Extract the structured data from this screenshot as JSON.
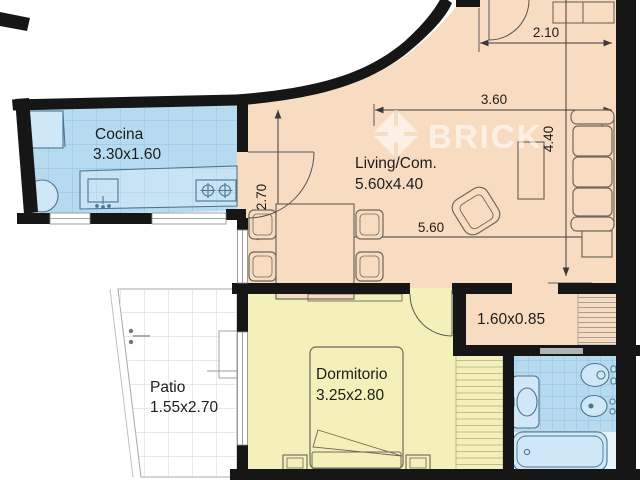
{
  "watermark": {
    "brand": "BRICK"
  },
  "rooms": {
    "cocina": {
      "label": "Cocina",
      "size": "3.30x1.60"
    },
    "living": {
      "label": "Living/Com.",
      "size": "5.60x4.40"
    },
    "dormitorio": {
      "label": "Dormitorio",
      "size": "3.25x2.80"
    },
    "patio": {
      "label": "Patio",
      "size": "1.55x2.70"
    },
    "pasillo": {
      "size": "1.60x0.85"
    }
  },
  "dimensions": {
    "entry": "2.10",
    "living_width": "3.60",
    "living_depth": "4.40",
    "living_length": "5.60",
    "kitchen_side": "2.70"
  },
  "colors": {
    "social_area": "#f8dcc2",
    "wet_area": "#b6dbf1",
    "bedroom_area": "#f3f0ba",
    "wall": "#161616"
  }
}
